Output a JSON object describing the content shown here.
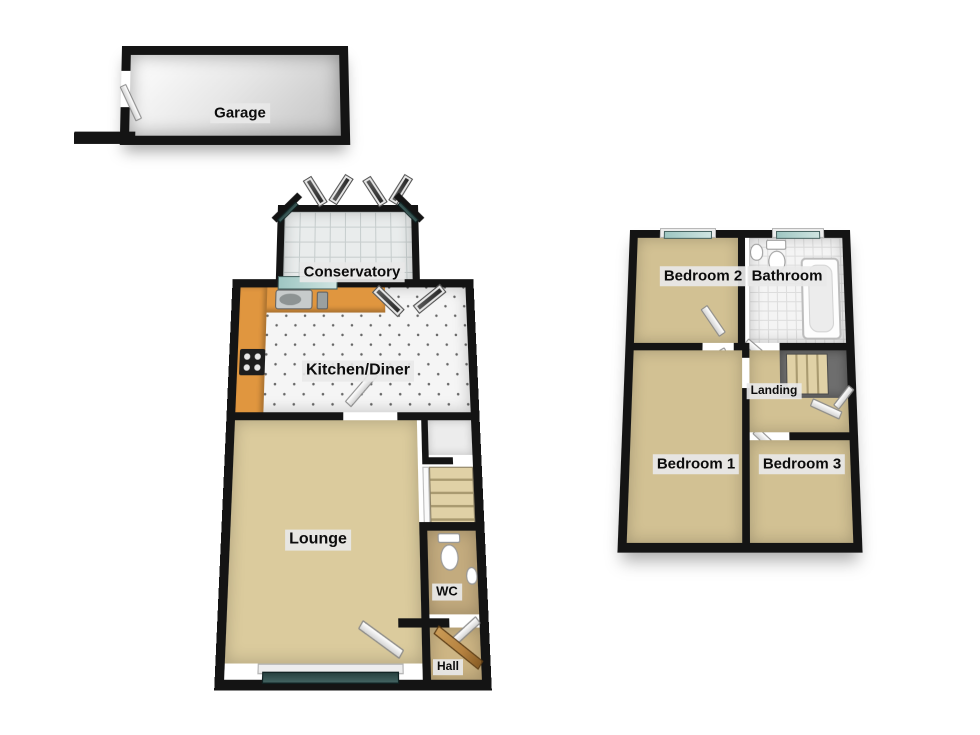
{
  "title": "3D floor plan",
  "labels": {
    "garage": "Garage",
    "conservatory": "Conservatory",
    "kitchen": "Kitchen/Diner",
    "lounge": "Lounge",
    "wc": "WC",
    "hall": "Hall",
    "bedroom1": "Bedroom 1",
    "bedroom2": "Bedroom 2",
    "bedroom3": "Bedroom 3",
    "bathroom": "Bathroom",
    "landing": "Landing"
  },
  "colors": {
    "wall": "#141414",
    "carpet": "#d2c193",
    "lounge_carpet": "#dbcb9d",
    "wc_floor": "#c3ab7e",
    "counter": "#e0963f",
    "tile": "#f5f5f5",
    "conservatory_tile": "#e9ecec",
    "glass": "#8fb8b4",
    "dark_glass": "#27413f",
    "stairwell": "#6e6e6e",
    "door_wood": "#b5813f",
    "label_bg": "#e8e8e8"
  }
}
